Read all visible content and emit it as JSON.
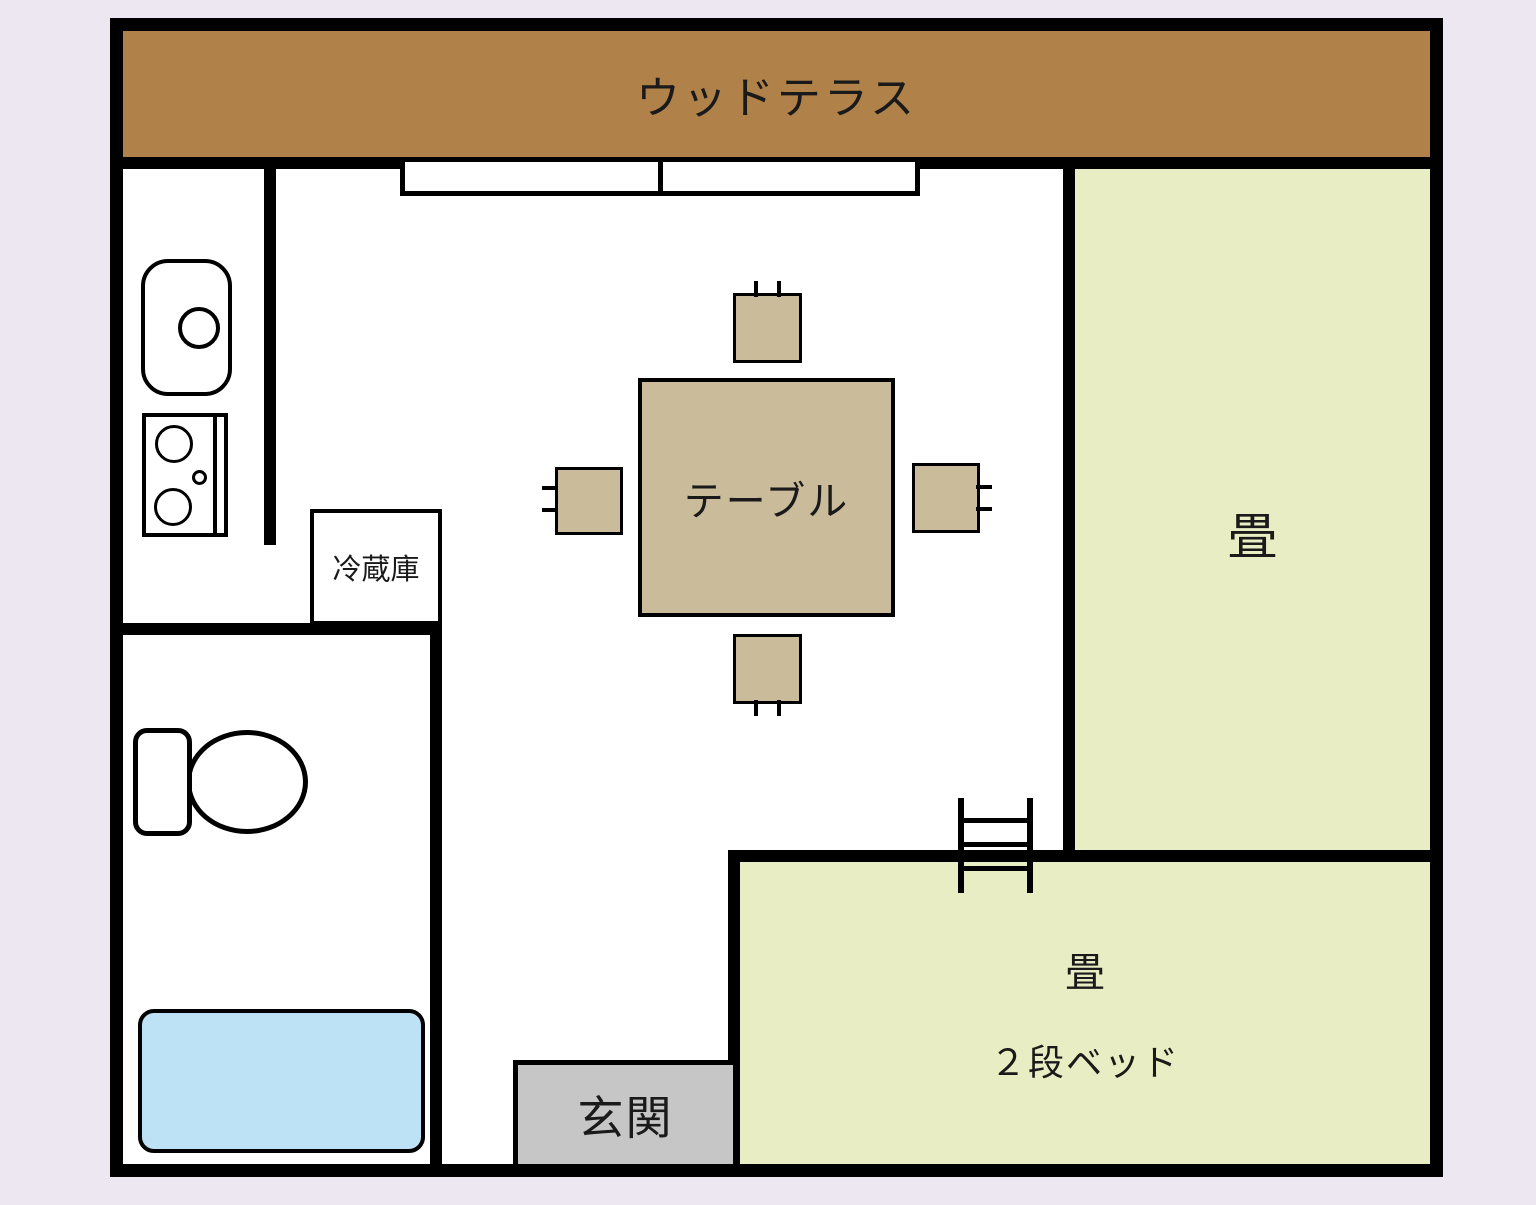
{
  "colors": {
    "background": "#ece7f0",
    "floor": "#ffffff",
    "wall": "#000000",
    "terrace": "#b08148",
    "tatami": "#e8edc3",
    "furniture_tan": "#cabc9b",
    "bathtub_blue": "#bde2f5",
    "entrance_gray": "#c6c6c6",
    "text": "#1a1a1a"
  },
  "rooms": {
    "terrace": {
      "label": "ウッドテラス"
    },
    "tatami_main": {
      "label": "畳"
    },
    "bunk_room": {
      "label_line1": "畳",
      "label_line2": "２段ベッド"
    },
    "entrance": {
      "label": "玄関"
    }
  },
  "furniture": {
    "table": {
      "label": "テーブル"
    },
    "fridge": {
      "label": "冷蔵庫"
    }
  },
  "fixtures": [
    "sink",
    "stove",
    "refrigerator",
    "dining-table",
    "chair",
    "toilet",
    "bathtub",
    "ladder",
    "sliding-window",
    "wood-terrace"
  ]
}
